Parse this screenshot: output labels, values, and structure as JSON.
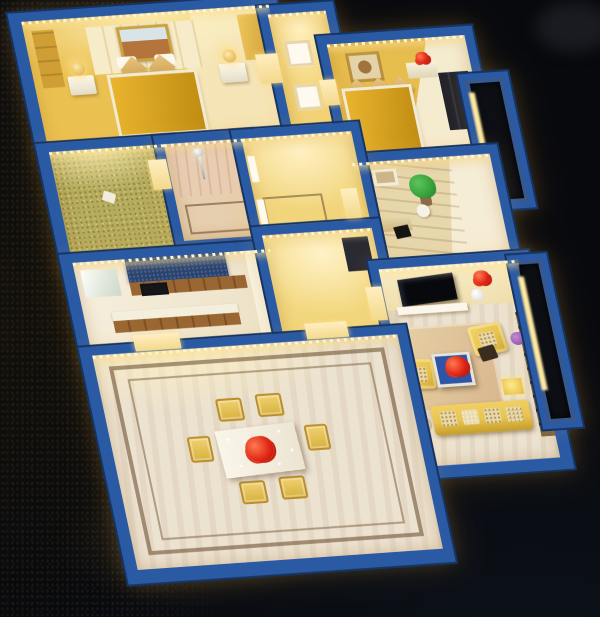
{
  "scene": {
    "type": "photograph",
    "subject": "illuminated architectural scale model of an apartment floor plan viewed from above at an angle",
    "lighting": "warm yellow interior LED strip lighting, dark surroundings",
    "structure": {
      "wall_top_color_name": "blue painted wall tops",
      "floor_materials": [
        "gold carpet",
        "marble with inlay borders",
        "wood planks",
        "artificial grass",
        "pink tile"
      ]
    },
    "rooms": [
      {
        "name": "master-bedroom",
        "position": "top-left",
        "furniture": [
          "framed-landscape-art",
          "headboard-panel",
          "double-bed-gold-quilt",
          "two-tan-pillows",
          "nightstand-left",
          "nightstand-right",
          "gold-table-lamps",
          "tall-cabinet",
          "led-strip"
        ]
      },
      {
        "name": "hallway-top",
        "position": "top-center",
        "furniture": [
          "white-door-frames"
        ]
      },
      {
        "name": "bedroom-2",
        "position": "top-right",
        "furniture": [
          "medallion-wall-art",
          "double-bed-gold-quilt",
          "three-pillows",
          "side-cabinet",
          "red-flowers",
          "dark-wardrobe",
          "led-strip"
        ]
      },
      {
        "name": "study-room",
        "position": "right-middle",
        "furniture": [
          "small-wall-frame",
          "green-potted-plant",
          "desk",
          "black-desk-chair",
          "white-chair",
          "wood-plank-floor"
        ]
      },
      {
        "name": "grass-balcony",
        "position": "left-middle",
        "furniture": [
          "artificial-grass-floor"
        ]
      },
      {
        "name": "bathroom",
        "position": "center-left",
        "furniture": [
          "chrome-shower-set",
          "tiled-wall",
          "floor-border-inlay"
        ]
      },
      {
        "name": "inner-hallway",
        "position": "center",
        "furniture": [
          "floor-border-inlay",
          "door-jambs"
        ]
      },
      {
        "name": "kitchen",
        "position": "left-lower",
        "furniture": [
          "navy-backsplash",
          "wood-upper-cabinets",
          "black-cooktop",
          "island-counter",
          "white-fridge-panel"
        ]
      },
      {
        "name": "foyer",
        "position": "center-lower",
        "furniture": [
          "dark-niche"
        ]
      },
      {
        "name": "living-room",
        "position": "bottom-right",
        "furniture": [
          "wall-mounted-tv",
          "white-tv-console",
          "red-flowers",
          "white-sphere-lamp",
          "beige-rug",
          "blue-coffee-table-with-red-flowers",
          "yellow-armchair-left",
          "yellow-armchair-right",
          "yellow-sofa-with-patterned-cushions",
          "gold-side-table",
          "glass-round-table",
          "dark-wood-display-shelf",
          "purple-flowers",
          "dark-accent-chair"
        ]
      },
      {
        "name": "dining-room",
        "position": "bottom-left",
        "furniture": [
          "marble-floor-double-inlay",
          "white-dining-table",
          "red-flower-centerpiece",
          "wine-glasses",
          "six-yellow-chairs",
          "led-strip"
        ]
      },
      {
        "name": "balcony-top-right",
        "position": "upper-right",
        "furniture": [
          "dark-window",
          "lit-sill"
        ]
      },
      {
        "name": "balcony-right",
        "position": "right",
        "furniture": [
          "dark-window",
          "lit-sill"
        ]
      }
    ],
    "background": [
      "dark carpet texture lower-left",
      "near-black backdrop",
      "out-of-focus dark object top-right",
      "warm light spill around model"
    ]
  },
  "palette": {
    "bg_dark": "#08090d",
    "wall_blue": "#2a5aa4",
    "wall_blue_dark": "#153463",
    "glow_white": "#fff6d8",
    "glow_yellow": "#ffd763",
    "gold_room": "#e7bd4e",
    "cream": "#f7ecca",
    "quilt_gold": "#d7a01d",
    "pillow_tan": "#d9b36a",
    "marble": "#ece2d0",
    "inlay_brown": "#6e4a2a",
    "grass_green": "#b3a95c",
    "wood_floor": "#e7d7ad",
    "cabinet_wood": "#9a6632",
    "backsplash_navy": "#2b4370",
    "counter_white": "#f4eedd",
    "sofa_yellow": "#e8c44f",
    "table_blue": "#2f55a8",
    "flower_red": "#e02414",
    "flower_orange": "#f25c22",
    "flower_purple": "#9a5ab8",
    "plant_green": "#3aa43c",
    "dark_wood": "#342414",
    "tile_pink": "#e9cdb3",
    "screen_black": "#0d0f14",
    "white": "#f8f5ec"
  }
}
